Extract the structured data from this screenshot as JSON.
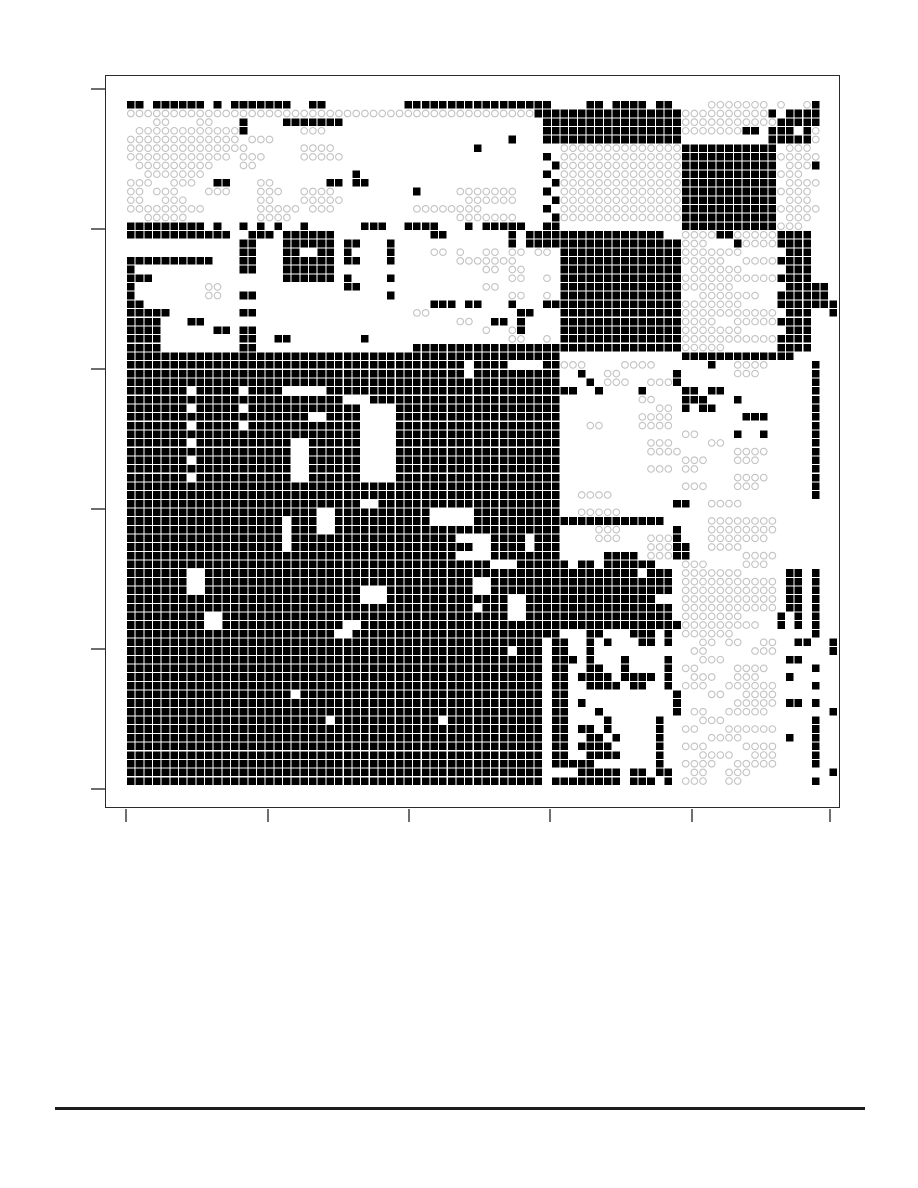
{
  "page": {
    "width": 918,
    "height": 1188,
    "background": "#ffffff",
    "visible_text": ""
  },
  "chart_data": {
    "type": "heatmap",
    "title": "",
    "xlabel": "",
    "ylabel": "",
    "tick_labels_visible": false,
    "legend": "none",
    "description": "Block-clustered binary matrix figure: filled black squares versus open light-gray circles on white; no text labels anywhere on the page.",
    "axes": {
      "x_tick_positions_px": [
        126,
        268,
        409,
        550,
        692,
        830
      ],
      "y_tick_positions_px": [
        89,
        229,
        369,
        509,
        649,
        789
      ],
      "frame_px": {
        "left": 105,
        "top": 75,
        "width": 735,
        "height": 733
      }
    },
    "layout": {
      "grid_origin_x": 21,
      "grid_origin_y": 25,
      "cell_pitch": 8.67,
      "cell_size": 7.6,
      "circle_radius": 3.3
    },
    "colors": {
      "cell_fill": "#000000",
      "circle_stroke": "#c2c2c2",
      "frame": "#2b2b2b",
      "tick": "#6e6e6e",
      "footer_rule": "#1c1c1c",
      "background": "#ffffff"
    },
    "grid": {
      "n_cols": 82,
      "n_rows": 79,
      "cell_types": {
        "#": "filled-black-square",
        "o": "open-gray-circle"
      },
      "encoding": "Each row string lists segments 'a-b t' or 'a t' (inclusive column ranges, t = # filled or o circle).",
      "row_segments": [
        "0-1# 3-8# 10# 12-18# 21-22# 32-48# 53-54# 56-59# 61-62# 67-70o 71-73o 75o 78o 79#",
        "0-46o 47-63# 64-73o 74# 76-78# 79#",
        "3-4o 8-9o 13# 18-24# 48-63# 64-74o 75-78# 79#",
        "1-12o 13# 20-22o 48-63# 64-70o 71-72# 74-76# 78# 79o",
        "0-12o 14-16o 44# 48-63# 74-78# 79o",
        "0-13o 20-23o 40# 50-63o 64-74# 76-78o",
        "0-11o 13-15o 20-24o 48# 50-63o 64-74# 75-79o",
        "1-9o 13-14o 49# 50-63o 64-74# 76-78o 79#",
        "2-8o 26# 48# 50-63o 64-74# 75-77o",
        "0-2o 5-7o 10-11# 15-16o 23-24# 26-27# 49# 50-63o 64-74# 76-79o",
        "0-1o 3-5o 9-11o 15-17o 20-23o 33# 38-44o 48# 50-63o 64-74# 75-78o",
        "0-1o 4-6o 15-16o 20-24o 39-44o 49# 50-63o 64-74# 76-78o",
        "0-8o 15-19o 21-23o 33-40o 48# 50-63o 64-74# 75-79o",
        "2-6o 15-18o 38-44o 49# 50-63o 64-74# 76-78o",
        "0-8# 10# 13# 15# 17# 20# 27-29# 32-35# 39# 41-45# 48-49# 64-74# 75-77o",
        "0-11# 14-16# 18-23# 35-36# 44# 46-49# 50-61# 64-67o 68-69# 70-74o 75-78#",
        "13-14# 18-23# 25-26# 30# 44# 46-49# 50-63# 64-66o 70# 71-74o 75-78#",
        "13-14# 18-19# 22-23# 25# 30# 35-36o 38o 41-42o 44-45o 47-48o 50-63# 64-70o 76-78#",
        "0-9# 13-14# 18-23# 25-26# 30# 38-44o 50-63# 64-68o 71-74o 75-78#",
        "0# 13-14# 18-23# 41-42o 44-45o 50-63# 65-70o 76-78#",
        "0-2# 18-23# 25# 30# 44-45o 48o 50-63# 64-74o 75-78#",
        "0# 9-10o 25-26# 41-42o 50-63# 64-69o 76-78# 79-80#",
        "0# 9-10o 13-14# 30# 44-45o 48o 50-63# 66-72o 75-78# 79-80#",
        "0-1# 35-37# 39-40# 44# 48-49# 50-63# 64-70o 75-78# 79-81#",
        "0-4# 13-14# 33-34o 45-46# 50-63# 64-74o 76-78# 81#",
        "0-3# 7-8# 38-39o 42-43# 45# 50-63# 64-67o 70-74o 75-78#",
        "0-3# 10-11# 13-14# 41o 44o 45# 50-63# 64-70o 76-78#",
        "0-3# 13-14# 17-18# 27# 44-45o 48o 50-63# 64-74o 75-78#",
        "0-3# 13-14# 33-49# 50-63# 64-68o 75-78#",
        "0-49# 64-74# 75-76#",
        "0-38# 40-43# 48-49# 50-52o 57-60o 67# 70-73o 79#",
        "0-38# 40-49# 52# 55-56o 63# 70-72o 79#",
        "0-49# 53# 55-57o 60-62o 63# 79#",
        "0-6# 8-12# 14-17# 23-49# 50-51# 54# 59# 64-65# 67-68# 79#",
        "0-24# 28-49# 59-60o 64-66# 70# 79#",
        "0-6# 8-12# 14-26# 31-49# 61-62o 64# 66-67# 79#",
        "0-20# 23-26# 31-49# 59-62o 71-73# 79#",
        "0-6# 8-12# 14-26# 31-49# 53-54o 59-62o 79#",
        "0-26# 31-49# 64-65o 70# 73# 79#",
        "0-6# 8-18# 21-26# 31-49# 60-62o 67-68o 79#",
        "0-18# 21-26# 31-49# 60-63o 70-73o 79#",
        "0-6# 8-18# 21-26# 31-49# 64-66o 70-72o 79#",
        "0-18# 21-26# 31-49# 60-62o 64-65o 79#",
        "0-6# 8-18# 21-26# 31-49# 70-73o 79#",
        "0-49# 64-66o 70-72o 79#",
        "0-49# 52-55o 79#",
        "0-26# 29-49# 63-64# 67-70o",
        "0-21# 24-34# 40-49# 52-56o",
        "0-17# 19-21# 24-34# 40-61# 67-74o",
        "0-17# 19-21# 24-49# 54-56o 63# 67-74o",
        "0-17# 19-37# 42-45# 47-49# 54-56o 60-62o 63# 67-73o",
        "0-17# 19-39# 42-45# 47-49# 60-62o 63-64# 67-70o",
        "0-37# 42-49# 55-58# 60-62o 63-64# 71-74o",
        "0-41# 45-50# 52-53# 55-60# 64-66o 71-73o",
        "0-6# 9-58# 60-62# 64-70o 76-77# 79#",
        "0-6# 9-39# 42-62# 64-74o 76-77# 79#",
        "0-6# 9-26# 30-39# 42-62# 64-74o 76-77# 79#",
        "0-26# 30-43# 46-60# 64-74o 76-77# 79#",
        "0-39# 41-43# 46-62# 64-74o 76-77# 79#",
        "0-8# 11-43# 46-62# 64-70o 75# 77# 79#",
        "0-8# 11-24# 27-63# 64-72o 75# 77# 79#",
        "0-23# 26-49# 53-54# 58-60# 62# 64-69o 79#",
        "0-47# 49-50# 53# 55# 59-60# 62# 66-67o 69-70o 73-74o 77-78# 81#",
        "0-43# 45-47# 49-50# 53# 65-66o 72-74o 81#",
        "0-47# 49-51# 53# 57# 62# 66-68o 76-77#",
        "0-47# 49-50# 53-54# 57# 62# 64-65o 70-73o 79#",
        "0-47# 49-50# 52-55# 57-60# 62# 65-67o 70-72o 76#",
        "0-47# 49-50# 53-56# 58-59# 62# 64-66o 69-74o 79#",
        "0-18# 20-47# 49-50# 63# 67-68o 71-74o",
        "0-47# 49-50# 52# 63# 70-74o 76-77# 79#",
        "0-47# 49-50# 54# 63# 65-66o 69-73o 81#",
        "0-22# 24-35# 37-47# 49-50# 55# 61# 66-68o 79#",
        "0-47# 49-50# 52-53# 55# 61# 64-65o 69-74o 79#",
        "0-47# 49-50# 53-54# 56# 61# 67-70o 76# 79#",
        "0-47# 49-50# 52-55# 61# 64-66o 71-74o 79#",
        "0-47# 49-50# 53-56# 61# 66-69o 72-74o 79#",
        "0-47# 49-53# 61# 64-67o 70-74o 79#",
        "0-47# 52-56# 58-59# 61-62# 65-66o 69-71o 81#",
        "0-47# 49-56# 58-60# 62# 64-66o 69-70o 79#"
      ]
    }
  },
  "footer": {
    "rule_present": true
  }
}
